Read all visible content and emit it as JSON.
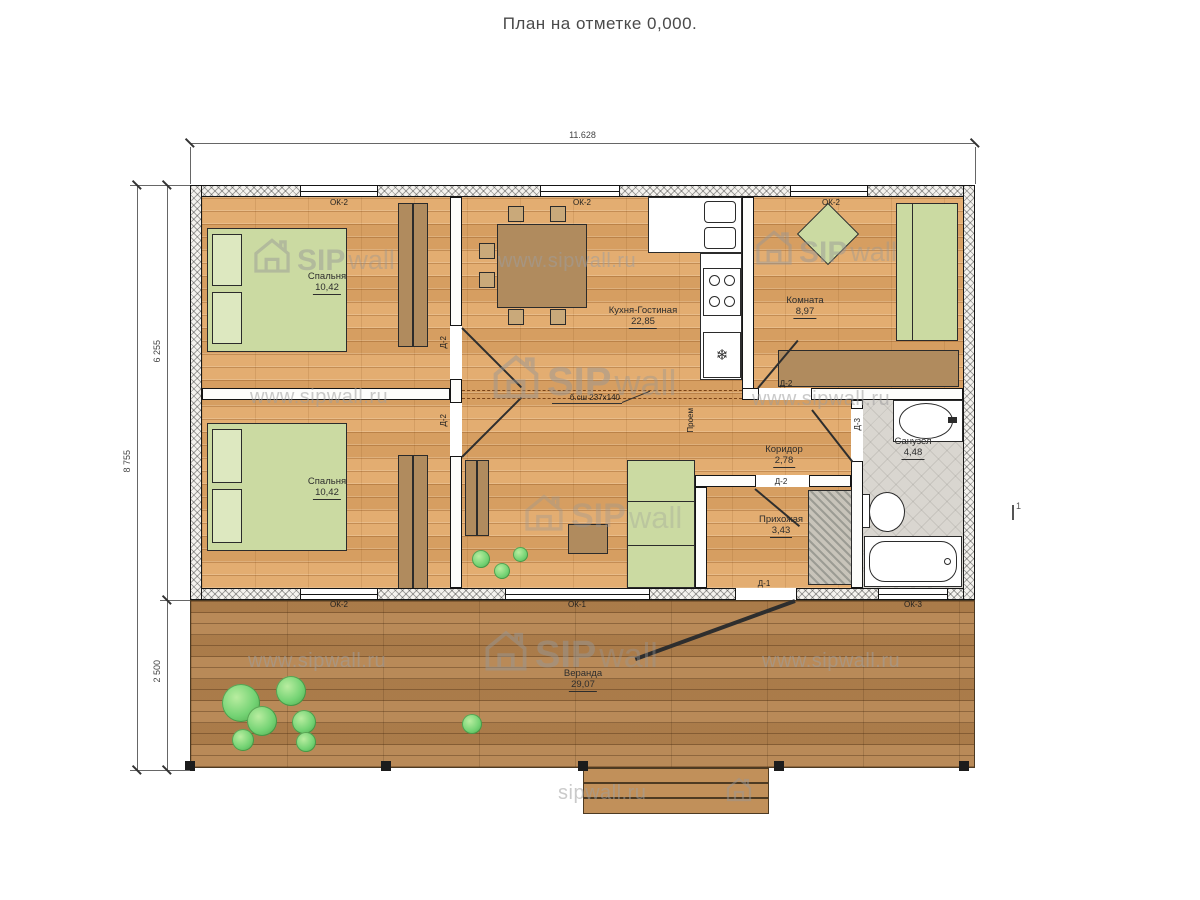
{
  "title": "План на отметке 0,000.",
  "dims": {
    "top": "11.628",
    "left_total": "8 755",
    "left_house": "6 255",
    "left_deck": "2 500"
  },
  "rooms": {
    "bedroom1": {
      "name": "Спальня",
      "area": "10,42"
    },
    "bedroom2": {
      "name": "Спальня",
      "area": "10,42"
    },
    "kitchen_living": {
      "name": "Кухня-Гостиная",
      "area": "22,85"
    },
    "room": {
      "name": "Комната",
      "area": "8,97"
    },
    "corridor": {
      "name": "Коридор",
      "area": "2,78"
    },
    "hallway": {
      "name": "Прихожая",
      "area": "3,43"
    },
    "bathroom": {
      "name": "Санузел",
      "area": "4,48"
    },
    "veranda": {
      "name": "Веранда",
      "area": "29,07"
    }
  },
  "openings": {
    "ok1": "ОК-1",
    "ok2": "ОК-2",
    "ok3": "ОК-3",
    "d1": "Д-1",
    "d2": "Д-2",
    "d3": "Д-3",
    "passage": "Проем",
    "beam_note": "б.сш 237х140",
    "section_mark": "1"
  },
  "symbols": {
    "fridge": "❄"
  },
  "watermark": {
    "url": "www.sipwall.ru",
    "sip": "SIP",
    "wall": "wall",
    "short": "sipwall.ru"
  },
  "colors": {
    "floor_wood": "#e1a766",
    "deck_wood": "#b5834e",
    "furniture_green": "#cbdaa2",
    "tile_grey": "#d9d6d0",
    "bush_green": "#74d374",
    "wall_line": "#151515"
  }
}
